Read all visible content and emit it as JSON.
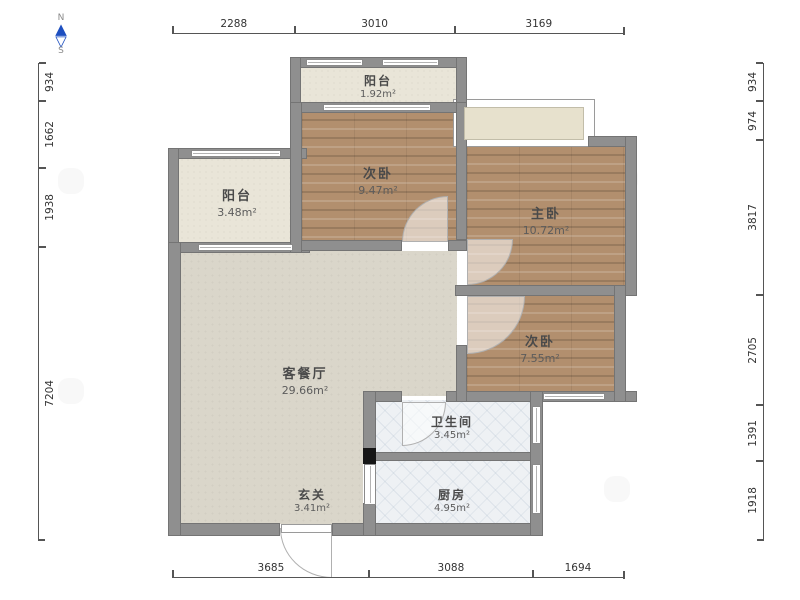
{
  "compass": {
    "north": "N",
    "south": "S"
  },
  "rooms": [
    {
      "name": "阳台",
      "area": "1.92m²"
    },
    {
      "name": "次卧",
      "area": "9.47m²"
    },
    {
      "name": "主卧",
      "area": "10.72m²"
    },
    {
      "name": "次卧",
      "area": "7.55m²"
    },
    {
      "name": "阳台",
      "area": "3.48m²"
    },
    {
      "name": "客餐厅",
      "area": "29.66m²"
    },
    {
      "name": "卫生间",
      "area": "3.45m²"
    },
    {
      "name": "厨房",
      "area": "4.95m²"
    },
    {
      "name": "玄关",
      "area": "3.41m²"
    }
  ],
  "dimensions": {
    "top": [
      "2288",
      "3010",
      "3169"
    ],
    "bottom": [
      "3685",
      "3088",
      "1694"
    ],
    "left": [
      "934",
      "1662",
      "1938",
      "7204"
    ],
    "right": [
      "934",
      "974",
      "3817",
      "2705",
      "1391",
      "1918"
    ]
  },
  "colors": {
    "wall": "#8f8f8f",
    "wood_floor": "#b28f6e",
    "living_floor": "#dad6ca",
    "balcony_floor": "#e9e5d8",
    "tile_floor": "#eef1f4",
    "compass_blue": "#1d4fc0",
    "dimension_text": "#333333"
  }
}
